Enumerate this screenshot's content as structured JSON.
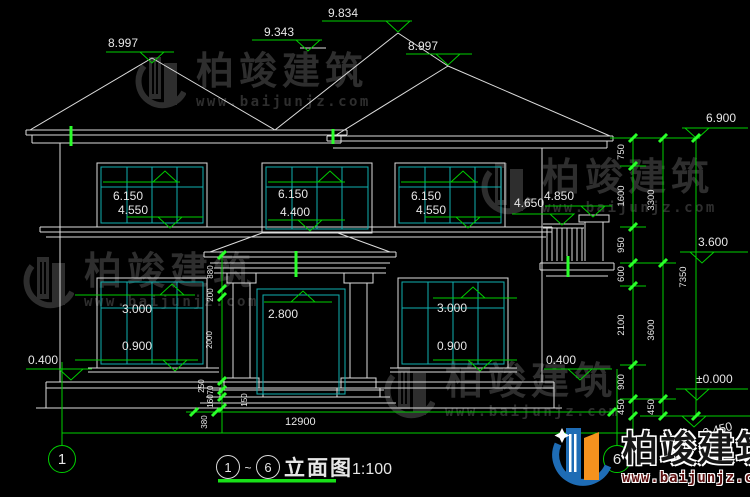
{
  "watermark": {
    "brand": "柏竣建筑",
    "url": "www.baijunjz.com"
  },
  "markers": {
    "m8997l": "8.997",
    "m9343": "9.343",
    "m9834": "9.834",
    "m8997r": "8.997",
    "m6900": "6.900",
    "m3600": "3.600",
    "m0000": "±0.000",
    "mneg450": "-0.450",
    "f2l_top": "6.150",
    "f2l_bot": "4.550",
    "f2m_top": "6.150",
    "f2m_bot": "4.400",
    "f2r_top": "6.150",
    "f2r_bot": "4.550",
    "f1l_top": "3.000",
    "f1l_bot": "0.900",
    "f1r_top": "3.000",
    "f1r_bot": "0.900",
    "door_top": "2.800",
    "bal_cap": "4.850",
    "bal_rail": "4.650",
    "plinth_l": "0.400",
    "plinth_r": "0.400"
  },
  "dims": {
    "col1": [
      "750",
      "1600",
      "950",
      "600",
      "2100",
      "900",
      "450"
    ],
    "col2": [
      "3300",
      "3600",
      "450"
    ],
    "col3": [
      "7350"
    ],
    "porch": [
      "880",
      "200",
      "2000",
      "250",
      "70",
      "160"
    ],
    "step": "150",
    "w380": "380",
    "w12900": "12900"
  },
  "axes": {
    "a1": "1",
    "a6": "6"
  },
  "title": {
    "c1": "1",
    "tilde": "~",
    "c2": "6",
    "label": "立面图",
    "scale": "1:100"
  },
  "colors": {
    "line": "#dcdcdc",
    "window": "#0fb0b0",
    "dimension": "#00cf00",
    "tick": "#2aff2a",
    "logo_blue": "#1e6cb5",
    "logo_orange": "#f6921e"
  }
}
